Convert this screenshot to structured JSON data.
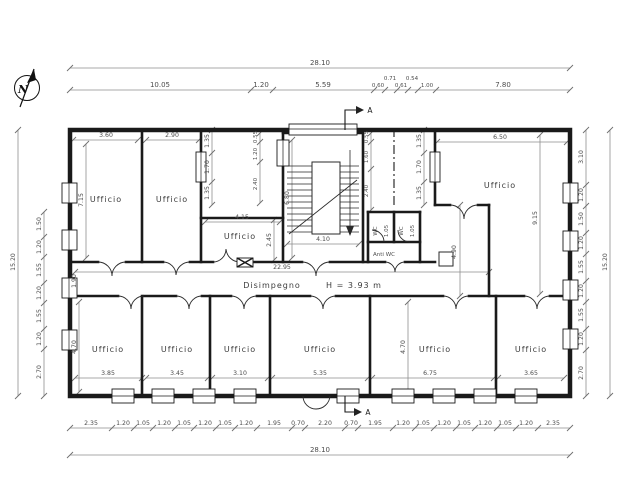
{
  "drawing": {
    "compass_label": "N",
    "section_marker_top": "A",
    "section_marker_bottom": "A"
  },
  "dims": {
    "top_overall": "28.10",
    "top_chain": [
      "10.05",
      "1.20",
      "5.59",
      "0.60",
      "0.71",
      "0.61",
      "0.54",
      "1.00",
      "7.80"
    ],
    "bottom_overall": "28.10",
    "bottom_chain": [
      "2.35",
      "1.20",
      "1.05",
      "1.20",
      "1.05",
      "1.20",
      "1.05",
      "1.20",
      "1.95",
      "0.70",
      "2.20",
      "0.70",
      "1.95",
      "1.20",
      "1.05",
      "1.20",
      "1.05",
      "1.20",
      "1.05",
      "1.20",
      "2.35"
    ],
    "left_overall": "15.20",
    "left_chain": [
      "1.50",
      "1.20",
      "1.55",
      "1.20",
      "1.55",
      "1.20",
      "2.70"
    ],
    "right_overall": "15.20",
    "right_chain": [
      "3.10",
      "1.20",
      "1.50",
      "1.20",
      "1.55",
      "1.20",
      "1.55",
      "1.20",
      "2.70"
    ],
    "wall_left_inner": [
      "1.35",
      "1.70",
      "1.35"
    ],
    "wall_right_inner": [
      "1.35",
      "1.70",
      "1.35"
    ],
    "hall_left": [
      "0.55",
      "1.20",
      "2.40"
    ],
    "hall_right": [
      "0.55",
      "1.60",
      "2.40"
    ]
  },
  "rooms": {
    "office_top_1": {
      "label": "Ufficio",
      "width": "3.60",
      "depth": "7.15"
    },
    "office_top_2": {
      "label": "Ufficio",
      "width": "2.90"
    },
    "office_mid": {
      "label": "Ufficio",
      "width": "4.15",
      "depth": "2.45"
    },
    "stair": {
      "width": "4.10",
      "depth": "6.80"
    },
    "wc_left": {
      "label": "WC",
      "width": "1.05"
    },
    "wc_right": {
      "label": "WC",
      "width": "1.05"
    },
    "anti_wc": {
      "label": "Anti WC"
    },
    "office_right": {
      "label": "Ufficio",
      "width": "6.50",
      "depth": "9.15",
      "annex_depth": "4.90"
    },
    "corridor": {
      "label": "Disimpegno",
      "height": "H = 3.93 m",
      "length": "22.95",
      "width": "1.90"
    },
    "office_b1": {
      "label": "Ufficio",
      "width": "3.85",
      "depth": "4.70"
    },
    "office_b2": {
      "label": "Ufficio",
      "width": "3.45"
    },
    "office_b3": {
      "label": "Ufficio",
      "width": "3.10"
    },
    "office_b4": {
      "label": "Ufficio",
      "width": "5.35"
    },
    "office_b5": {
      "label": "Ufficio",
      "width": "6.75",
      "depth": "4.70"
    },
    "office_b6": {
      "label": "Ufficio",
      "width": "3.65"
    }
  }
}
